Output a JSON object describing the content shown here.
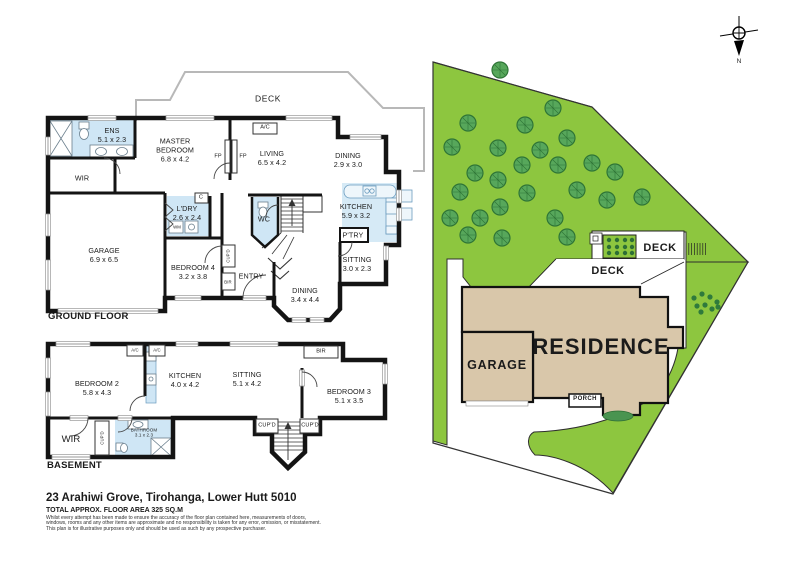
{
  "colors": {
    "lawn": "#8dc63f",
    "tree": "#57a75b",
    "building": "#d9c7aa",
    "wet_area": "#cfe6f5",
    "wall": "#141414"
  },
  "footer": {
    "address": "23 Arahiwi Grove, Tirohanga, Lower Hutt 5010",
    "area": "TOTAL APPROX. FLOOR AREA 325 SQ.M",
    "disclaimer": [
      "Whilst every attempt has been made to ensure the accuracy of the floor plan contained here, measurements of doors,",
      "windows, rooms and any other items are approximate and no responsibility is taken for any error, omission, or misstatement.",
      "This plan is for illustrative purposes only and should be used as such by any prospective purchaser."
    ]
  },
  "ground_floor": {
    "title": "GROUND FLOOR",
    "rooms": [
      {
        "n": "room-label-ens",
        "name": "ENS",
        "dims": "5.1 x 2.3",
        "x": 112,
        "y": 135
      },
      {
        "n": "room-label-master-bedroom",
        "name": "MASTER\nBEDROOM",
        "dims": "6.8 x 4.2",
        "x": 175,
        "y": 150
      },
      {
        "n": "room-label-living",
        "name": "LIVING",
        "dims": "6.5 x 4.2",
        "x": 272,
        "y": 158
      },
      {
        "n": "room-label-dining-small",
        "name": "DINING",
        "dims": "2.9 x 3.0",
        "x": 348,
        "y": 160
      },
      {
        "n": "room-label-kitchen",
        "name": "KITCHEN",
        "dims": "5.9 x 3.2",
        "x": 356,
        "y": 211
      },
      {
        "n": "room-label-sitting",
        "name": "SITTING",
        "dims": "3.0 x 2.3",
        "x": 357,
        "y": 264
      },
      {
        "n": "room-label-laundry",
        "name": "L'DRY",
        "dims": "2.6 x 2.4",
        "x": 187,
        "y": 213
      },
      {
        "n": "room-label-garage",
        "name": "GARAGE",
        "dims": "6.9 x 6.5",
        "x": 104,
        "y": 255
      },
      {
        "n": "room-label-bedroom4",
        "name": "BEDROOM 4",
        "dims": "3.2 x 3.8",
        "x": 193,
        "y": 272
      },
      {
        "n": "room-label-dining-main",
        "name": "DINING",
        "dims": "3.4 x 4.4",
        "x": 305,
        "y": 295
      }
    ],
    "labels": [
      {
        "n": "deck-label",
        "t": "DECK",
        "x": 268,
        "y": 99,
        "c": "deck"
      },
      {
        "n": "wir-label",
        "t": "WIR",
        "x": 82,
        "y": 178,
        "c": ""
      },
      {
        "n": "fireplace-label-1",
        "t": "FP",
        "x": 218,
        "y": 157,
        "c": "tiny"
      },
      {
        "n": "fireplace-label-2",
        "t": "FP",
        "x": 243,
        "y": 157,
        "c": "tiny"
      },
      {
        "n": "ac-label",
        "t": "A/C",
        "x": 265,
        "y": 128,
        "c": "tiny"
      },
      {
        "n": "cupboard-c-label",
        "t": "C",
        "x": 201,
        "y": 198,
        "c": "tiny"
      },
      {
        "n": "washing-machine-label",
        "t": "WM",
        "x": 177,
        "y": 227,
        "c": "micro"
      },
      {
        "n": "wc-label",
        "t": "WC",
        "x": 264,
        "y": 219,
        "c": ""
      },
      {
        "n": "pantry-label",
        "t": "P'TRY",
        "x": 353,
        "y": 235,
        "c": ""
      },
      {
        "n": "entry-label",
        "t": "ENTRY",
        "x": 251,
        "y": 276,
        "c": ""
      },
      {
        "n": "cupboard-label",
        "t": "CUP'D",
        "x": 228,
        "y": 256,
        "c": "micro v"
      },
      {
        "n": "bir-label",
        "t": "BIR",
        "x": 228,
        "y": 282,
        "c": "micro"
      }
    ]
  },
  "basement": {
    "title": "BASEMENT",
    "rooms": [
      {
        "n": "room-label-bedroom2",
        "name": "BEDROOM 2",
        "dims": "5.8 x 4.3",
        "x": 97,
        "y": 388
      },
      {
        "n": "room-label-kitchen-b",
        "name": "KITCHEN",
        "dims": "4.0 x 4.2",
        "x": 185,
        "y": 380
      },
      {
        "n": "room-label-sitting-b",
        "name": "SITTING",
        "dims": "5.1 x 4.2",
        "x": 247,
        "y": 379
      },
      {
        "n": "room-label-bedroom3",
        "name": "BEDROOM 3",
        "dims": "5.1 x 3.5",
        "x": 349,
        "y": 396
      },
      {
        "n": "room-label-bathroom",
        "name": "BATHROOM",
        "dims": "3.1 x 2.3",
        "x": 144,
        "y": 433,
        "c": "micro-room"
      }
    ],
    "labels": [
      {
        "n": "ac-label-b1",
        "t": "A/C",
        "x": 135,
        "y": 350,
        "c": "micro"
      },
      {
        "n": "ac-label-b2",
        "t": "A/C",
        "x": 157,
        "y": 350,
        "c": "micro"
      },
      {
        "n": "bir-label-b",
        "t": "BIR",
        "x": 321,
        "y": 352,
        "c": "tiny"
      },
      {
        "n": "wir-label-b",
        "t": "WIR",
        "x": 71,
        "y": 440,
        "c": "room-lg"
      },
      {
        "n": "cupboard-label-b1",
        "t": "CUP'D",
        "x": 102,
        "y": 438,
        "c": "micro v"
      },
      {
        "n": "cupboard-label-b2",
        "t": "CUP'D",
        "x": 267,
        "y": 426,
        "c": "tiny"
      },
      {
        "n": "cupboard-label-b3",
        "t": "CUP'D",
        "x": 310,
        "y": 426,
        "c": "tiny"
      }
    ]
  },
  "site_plan": {
    "labels": [
      {
        "n": "site-deck-upper-label",
        "t": "DECK",
        "x": 660,
        "y": 249,
        "c": "site-deck"
      },
      {
        "n": "site-deck-lower-label",
        "t": "DECK",
        "x": 608,
        "y": 272,
        "c": "site-deck"
      },
      {
        "n": "site-garage-label",
        "t": "GARAGE",
        "x": 497,
        "y": 366,
        "c": "site-garage"
      },
      {
        "n": "site-residence-label",
        "t": "RESIDENCE",
        "x": 601,
        "y": 347,
        "c": "site-res"
      },
      {
        "n": "site-porch-label",
        "t": "PORCH",
        "x": 585,
        "y": 400,
        "c": "porch"
      },
      {
        "n": "compass-north-label",
        "t": "N",
        "x": 739,
        "y": 62,
        "c": "compass-n"
      }
    ],
    "trees": [
      [
        468,
        123
      ],
      [
        500,
        70
      ],
      [
        553,
        108
      ],
      [
        525,
        125
      ],
      [
        452,
        147
      ],
      [
        498,
        148
      ],
      [
        540,
        150
      ],
      [
        567,
        138
      ],
      [
        522,
        165
      ],
      [
        558,
        165
      ],
      [
        592,
        163
      ],
      [
        615,
        172
      ],
      [
        475,
        173
      ],
      [
        498,
        180
      ],
      [
        460,
        192
      ],
      [
        527,
        193
      ],
      [
        577,
        190
      ],
      [
        607,
        200
      ],
      [
        642,
        197
      ],
      [
        500,
        207
      ],
      [
        450,
        218
      ],
      [
        480,
        218
      ],
      [
        555,
        218
      ],
      [
        468,
        235
      ],
      [
        502,
        238
      ],
      [
        567,
        237
      ]
    ],
    "bushes": [
      [
        694,
        298
      ],
      [
        702,
        294
      ],
      [
        710,
        297
      ],
      [
        717,
        302
      ],
      [
        697,
        306
      ],
      [
        705,
        305
      ],
      [
        712,
        309
      ],
      [
        718,
        307
      ],
      [
        701,
        312
      ]
    ]
  }
}
